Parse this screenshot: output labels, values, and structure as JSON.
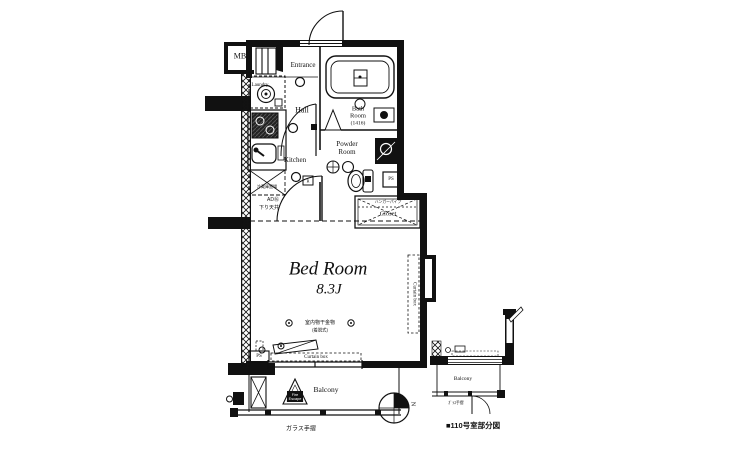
{
  "palette": {
    "ink": "#111111",
    "background": "#ffffff"
  },
  "floor_plan": {
    "unit": {
      "mb": "MB",
      "entrance": "Entrance",
      "hall": "Hall",
      "laundry": "Laundry",
      "kitchen": "Kitchen",
      "bath": {
        "line1": "Bath",
        "line2": "Room",
        "size": "(1416)"
      },
      "powder": {
        "line1": "Powder",
        "line2": "Room"
      },
      "closet": {
        "label": "Closet",
        "note": "ハンガーパイプ"
      },
      "bedroom": {
        "label": "Bed Room",
        "size": "8.3J"
      },
      "pipe_space_upper": "PS",
      "pipe_space_lower": "PS",
      "outlet_mark": "R",
      "door_tag": "AD⑯",
      "lowered_ceiling": "下り天井",
      "fridge_space": "冷蔵庫置場",
      "drying": {
        "label": "室内物干金物",
        "sub": "(着脱式)"
      },
      "curtain_box_bottom": "Curtain box",
      "curtain_box_right": "Curtain box",
      "balcony": "Balcony",
      "fire_escape": {
        "line1": "Fire",
        "line2": "Escape"
      },
      "glass_rail": "ガラス手摺"
    },
    "compass": {
      "north": "N"
    },
    "inset": {
      "balcony": "Balcony",
      "glass_rail": "ｶﾞﾗｽ手摺",
      "caption": "■110号室部分図"
    }
  }
}
